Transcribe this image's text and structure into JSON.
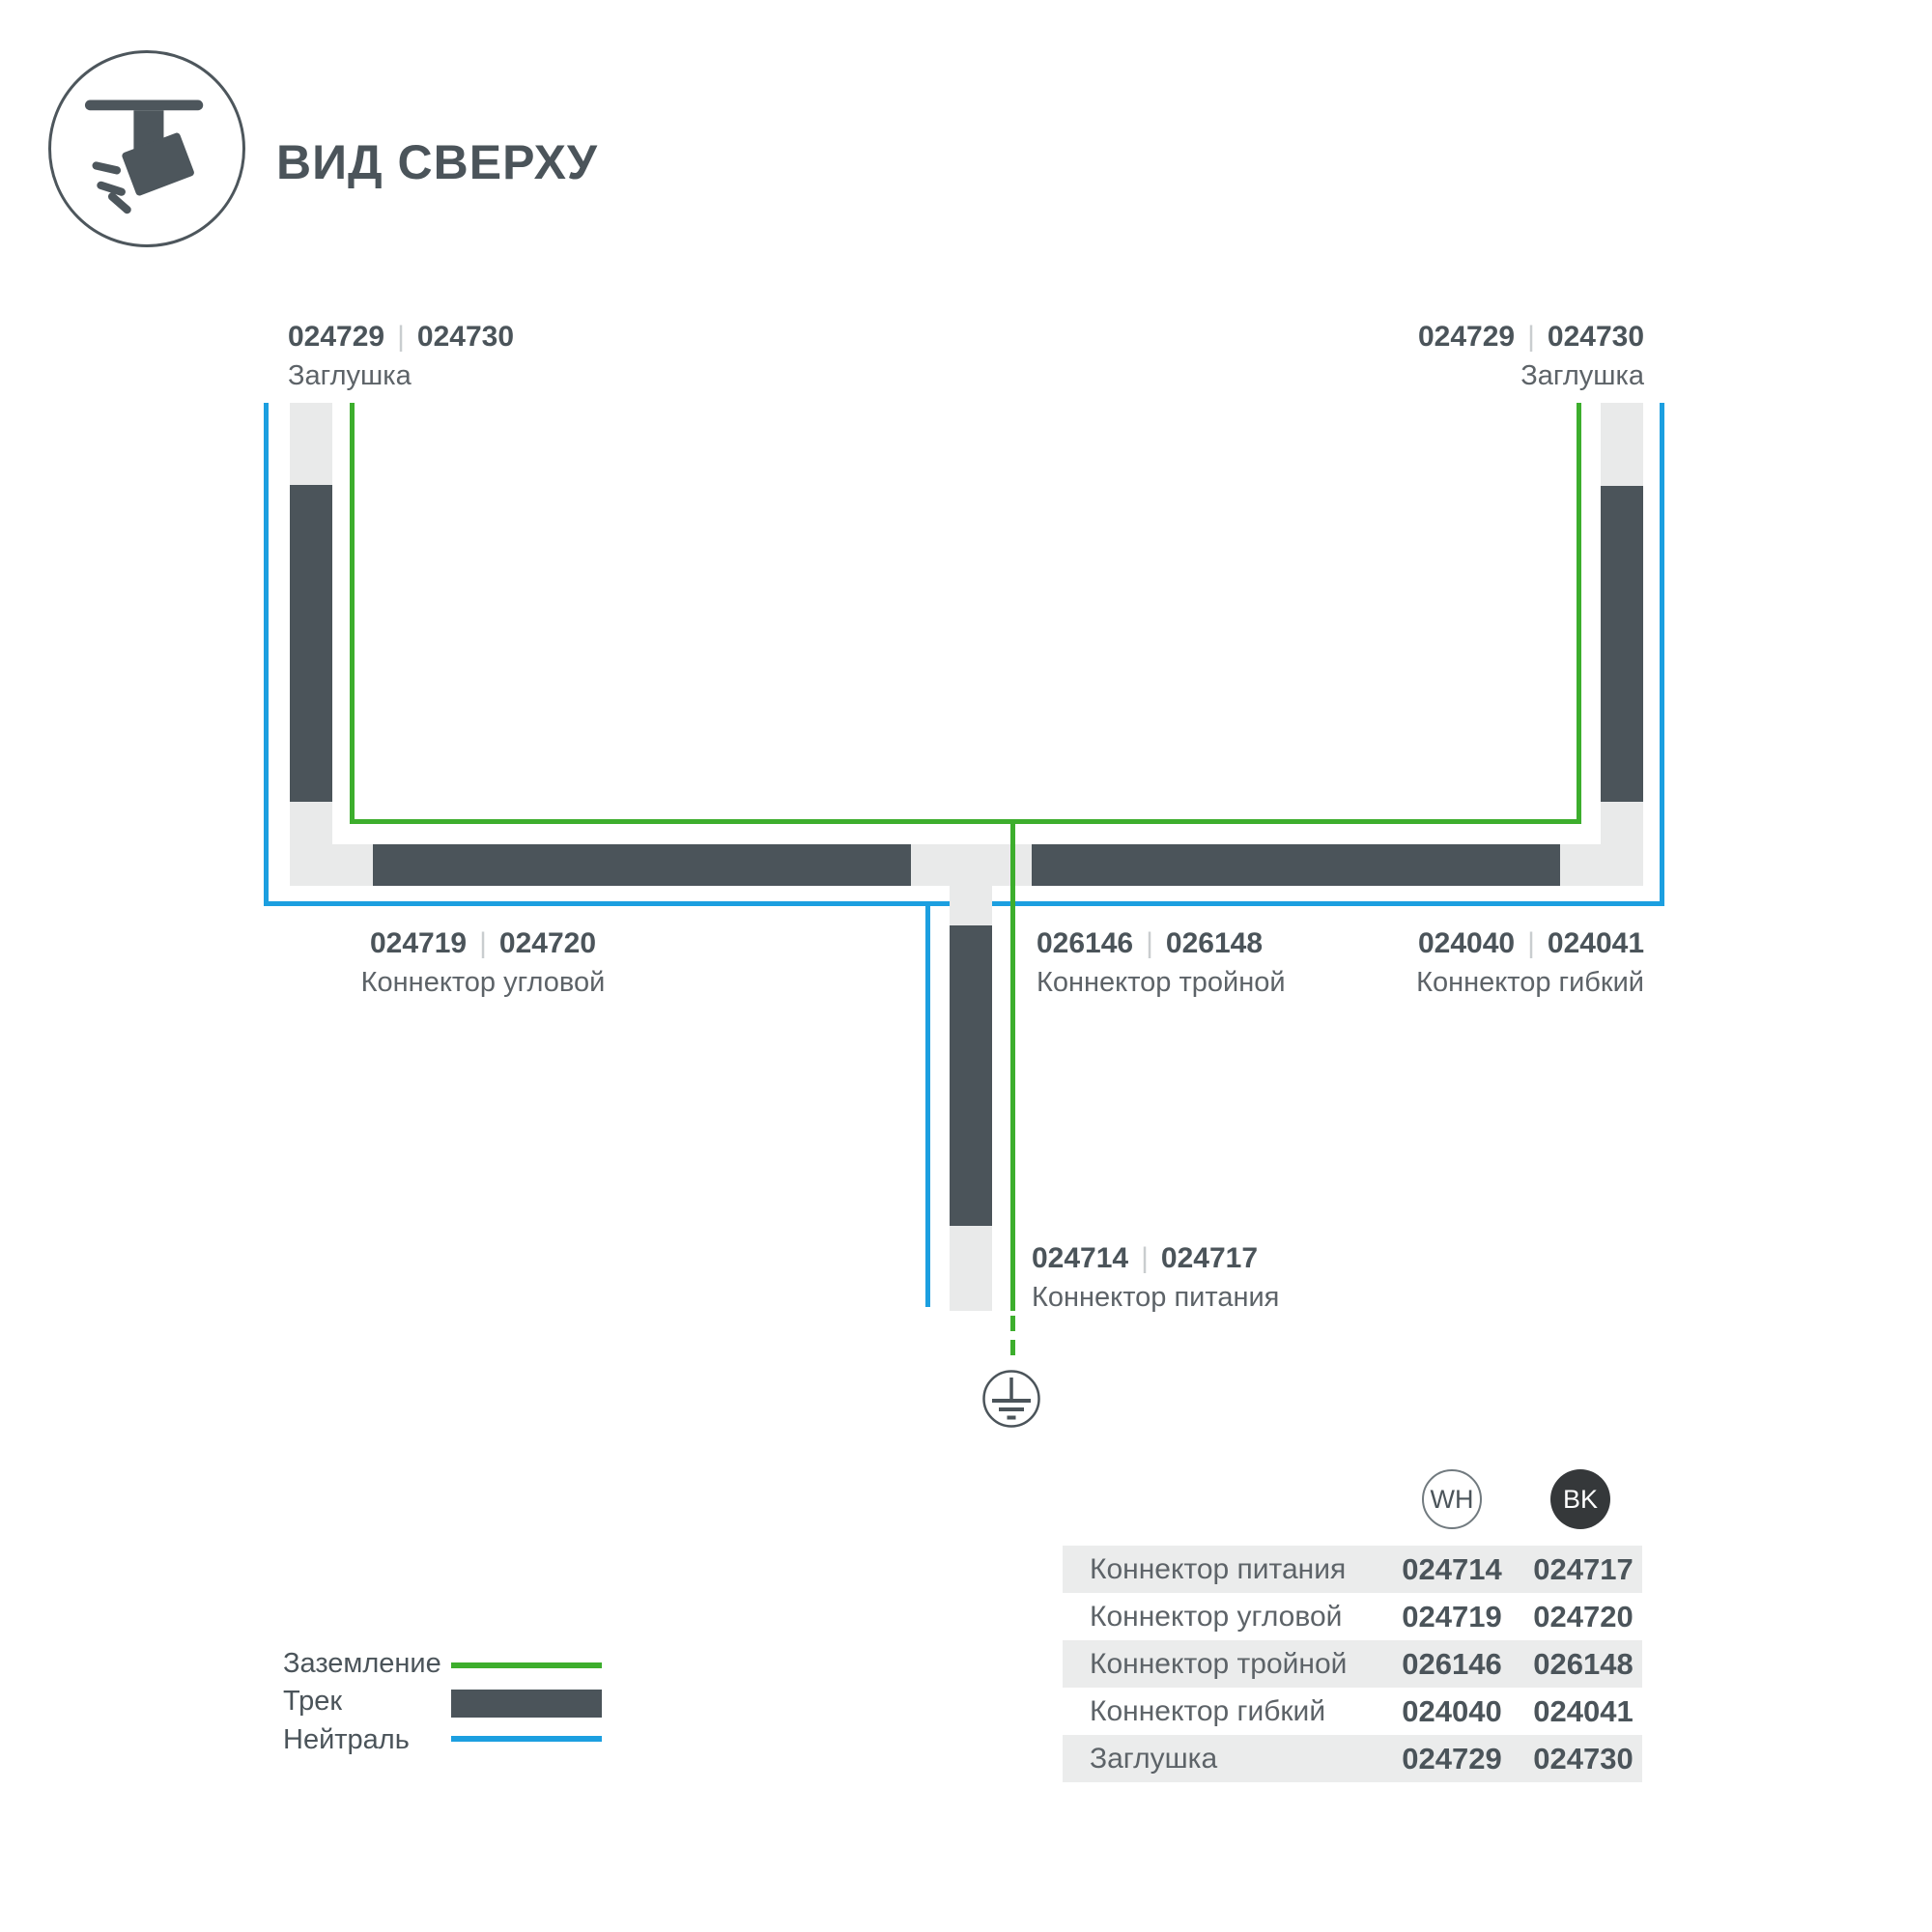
{
  "palette": {
    "track_dark": "#4b545a",
    "ground_green": "#3dae2d",
    "neutral_blue": "#1c9fe0",
    "connector_light": "#e9eaea",
    "table_row_gray": "#ebecec",
    "bk_badge": "#35383a"
  },
  "header": {
    "title": "ВИД СВЕРХУ",
    "icon": "track-spotlight-icon"
  },
  "diagram": {
    "separator": "|",
    "ground_symbol": "earth-ground-icon",
    "labels": [
      {
        "wh": "024729",
        "bk": "024730",
        "name": "Заглушка"
      },
      {
        "wh": "024729",
        "bk": "024730",
        "name": "Заглушка"
      },
      {
        "wh": "024719",
        "bk": "024720",
        "name": "Коннектор угловой"
      },
      {
        "wh": "026146",
        "bk": "026148",
        "name": "Коннектор тройной"
      },
      {
        "wh": "024040",
        "bk": "024041",
        "name": "Коннектор гибкий"
      },
      {
        "wh": "024714",
        "bk": "024717",
        "name": "Коннектор питания"
      }
    ]
  },
  "legend": {
    "items": [
      {
        "label": "Заземление",
        "swatch": "ground-line"
      },
      {
        "label": "Трек",
        "swatch": "track-bar"
      },
      {
        "label": "Нейтраль",
        "swatch": "neutral-line"
      }
    ]
  },
  "table": {
    "columns": [
      {
        "code": "WH"
      },
      {
        "code": "BK"
      }
    ],
    "rows": [
      {
        "name": "Коннектор питания",
        "wh": "024714",
        "bk": "024717"
      },
      {
        "name": "Коннектор угловой",
        "wh": "024719",
        "bk": "024720"
      },
      {
        "name": "Коннектор тройной",
        "wh": "026146",
        "bk": "026148"
      },
      {
        "name": "Коннектор гибкий",
        "wh": "024040",
        "bk": "024041"
      },
      {
        "name": "Заглушка",
        "wh": "024729",
        "bk": "024730"
      }
    ]
  }
}
